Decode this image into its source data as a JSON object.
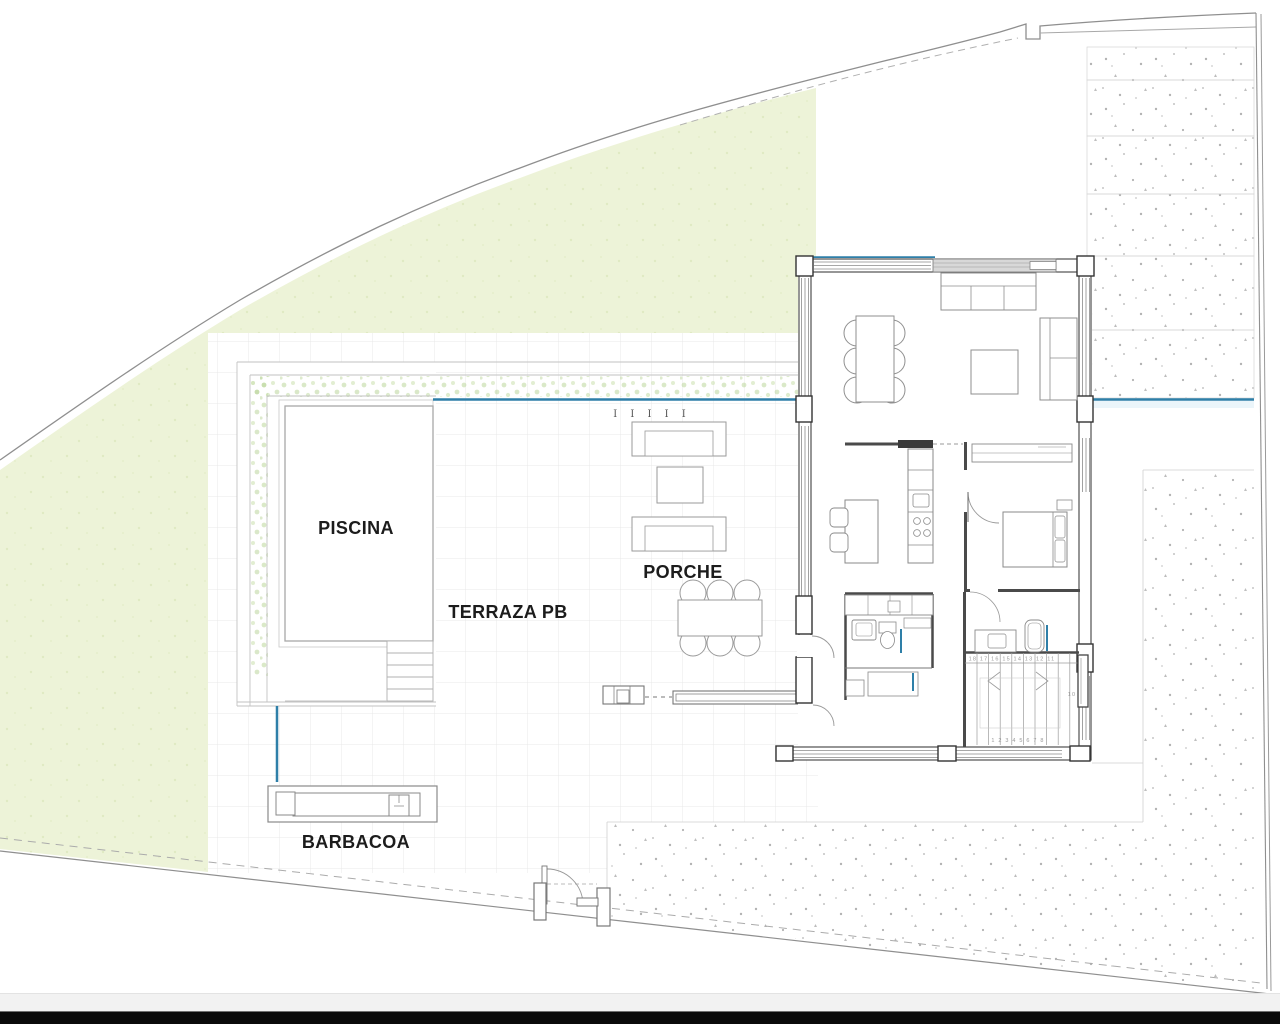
{
  "labels": {
    "piscina": "PISCINA",
    "terraza": "TERRAZA PB",
    "porche": "PORCHE",
    "barbacoa": "BARBACOA"
  },
  "marks": {
    "fence_posts": "I I I I I",
    "stair_numbers_top": "18 17 16 15 14 13 12 11",
    "stair_numbers_bottom": "1 2 3 4 5 6 7 8",
    "stair_number_mid": "10"
  },
  "colors": {
    "garden_green": "#edf3d8",
    "hedge_green": "#bcd69b",
    "accent_blue": "#2e7fa8",
    "wall_dark": "#3f3f3f",
    "furniture_gray": "#8a8a8a",
    "grid_gray": "#e9e9e9",
    "stipple_gray": "#b3b3b3",
    "boundary_gray": "#8f8f8f",
    "status_strip_gray": "#f2f2f2",
    "taskbar_black": "#0a0a0a"
  }
}
